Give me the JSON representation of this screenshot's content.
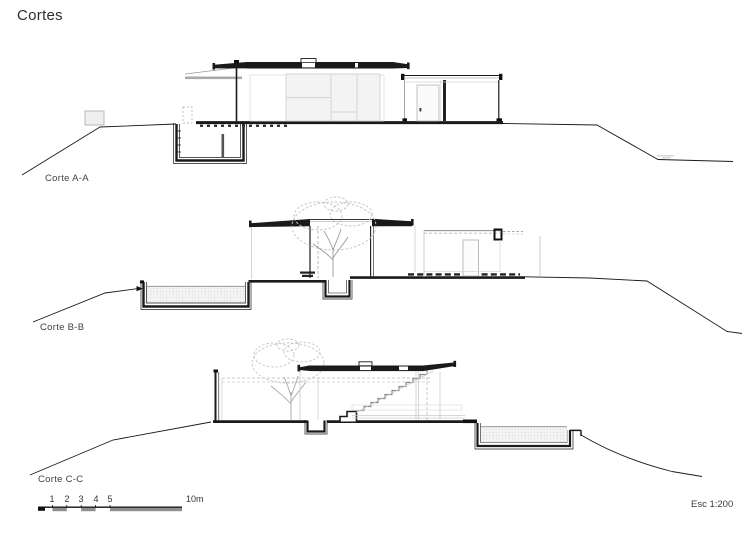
{
  "page": {
    "title": "Cortes",
    "scale_note": "Esc 1:200"
  },
  "sections": [
    {
      "label": "Corte A-A"
    },
    {
      "label": "Corte B-B"
    },
    {
      "label": "Corte C-C"
    }
  ],
  "scale_bar": {
    "ticks": [
      "1",
      "2",
      "3",
      "4",
      "5"
    ],
    "end_label": "10m"
  },
  "colors": {
    "ink": "#1a1a1a",
    "mid_gray": "#8f8f8f",
    "light_gray": "#c9c9c9",
    "tree_gray": "#bdbdbd",
    "water_hatch": "#d0d0d0"
  }
}
